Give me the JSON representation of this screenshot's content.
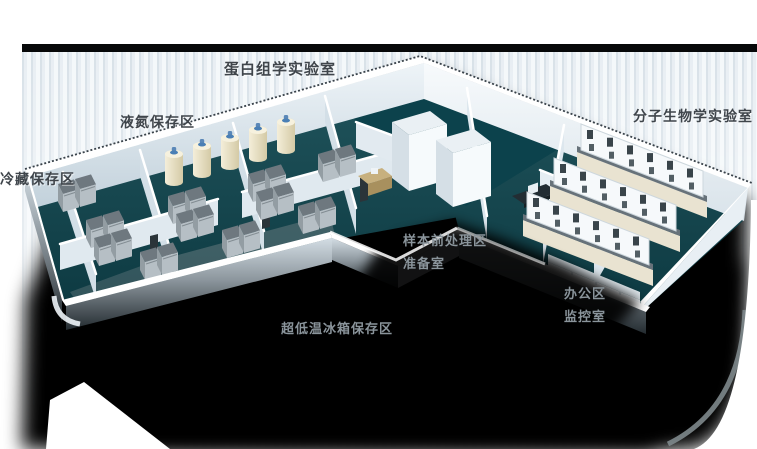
{
  "labels": {
    "proteomics_lab": "蛋白组学实验室",
    "ln2_storage": "液氮保存区",
    "cold_storage": "冷藏保存区",
    "molecular_biology_lab": "分子生物学实验室",
    "sample_prep_line1": "样本前处理区",
    "sample_prep_line2": "准备室",
    "office_line1": "办公区",
    "office_line2": "监控室",
    "ult_freezer_storage": "超低温冰箱保存区"
  },
  "colors": {
    "floor_teal": "#12454e",
    "wall_white": "#ffffff",
    "wall_shade": "#c9d6e0",
    "label_dark": "#3f454b",
    "label_light": "#8a949b",
    "shadow_black": "#000000",
    "tank_cream": "#e9e1c6",
    "tank_cap_blue": "#4a7fb5",
    "freezer_gray": "#77818a",
    "bench_counter": "#67727a",
    "panel_stripe": "#d8e1e8",
    "topbar_black": "#070809"
  }
}
